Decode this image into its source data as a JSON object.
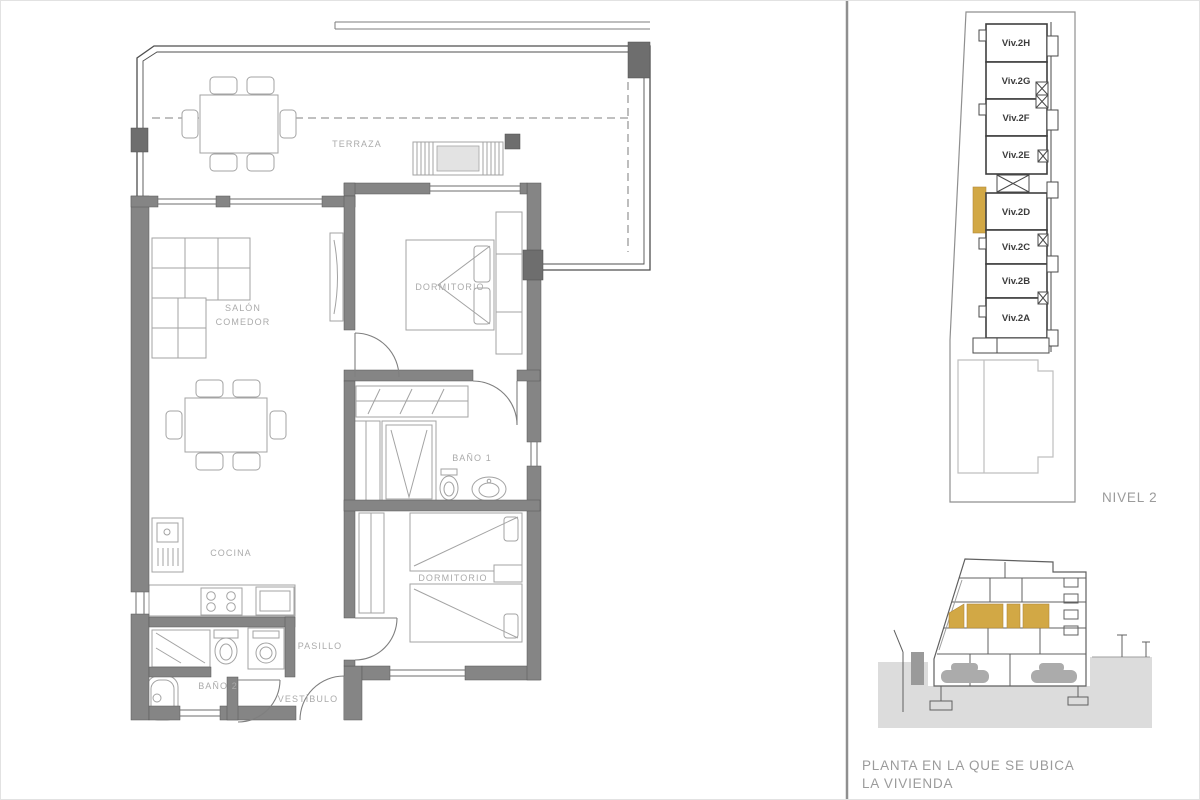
{
  "colors": {
    "accent": "#d2a845",
    "wall_gray": "#858585",
    "wall_dark_gray": "#6e6e6e",
    "label_gray": "#ababab",
    "caption_gray": "#9b9b9b",
    "ground_gray": "#dcdcdc"
  },
  "floor_plan": {
    "labels": {
      "terraza": "TERRAZA",
      "salon_line1": "SALÓN",
      "salon_line2": "COMEDOR",
      "dormitorio_1": "DORMITORIO",
      "bano_1": "BAÑO 1",
      "cocina": "COCINA",
      "dormitorio_2": "DORMITORIO",
      "pasillo": "PASILLO",
      "bano_2": "BAÑO 2",
      "vestibulo": "VESTÍBULO"
    }
  },
  "key_plan": {
    "level_label": "NIVEL 2",
    "highlighted_unit": "Viv.2D",
    "units": [
      {
        "label": "Viv.2H",
        "highlighted": false
      },
      {
        "label": "Viv.2G",
        "highlighted": false
      },
      {
        "label": "Viv.2F",
        "highlighted": false
      },
      {
        "label": "Viv.2E",
        "highlighted": false
      },
      {
        "label": "Viv.2D",
        "highlighted": true
      },
      {
        "label": "Viv.2C",
        "highlighted": false
      },
      {
        "label": "Viv.2B",
        "highlighted": false
      },
      {
        "label": "Viv.2A",
        "highlighted": false
      }
    ]
  },
  "section_caption": {
    "line1": "PLANTA EN LA QUE SE UBICA",
    "line2": "LA VIVIENDA"
  }
}
